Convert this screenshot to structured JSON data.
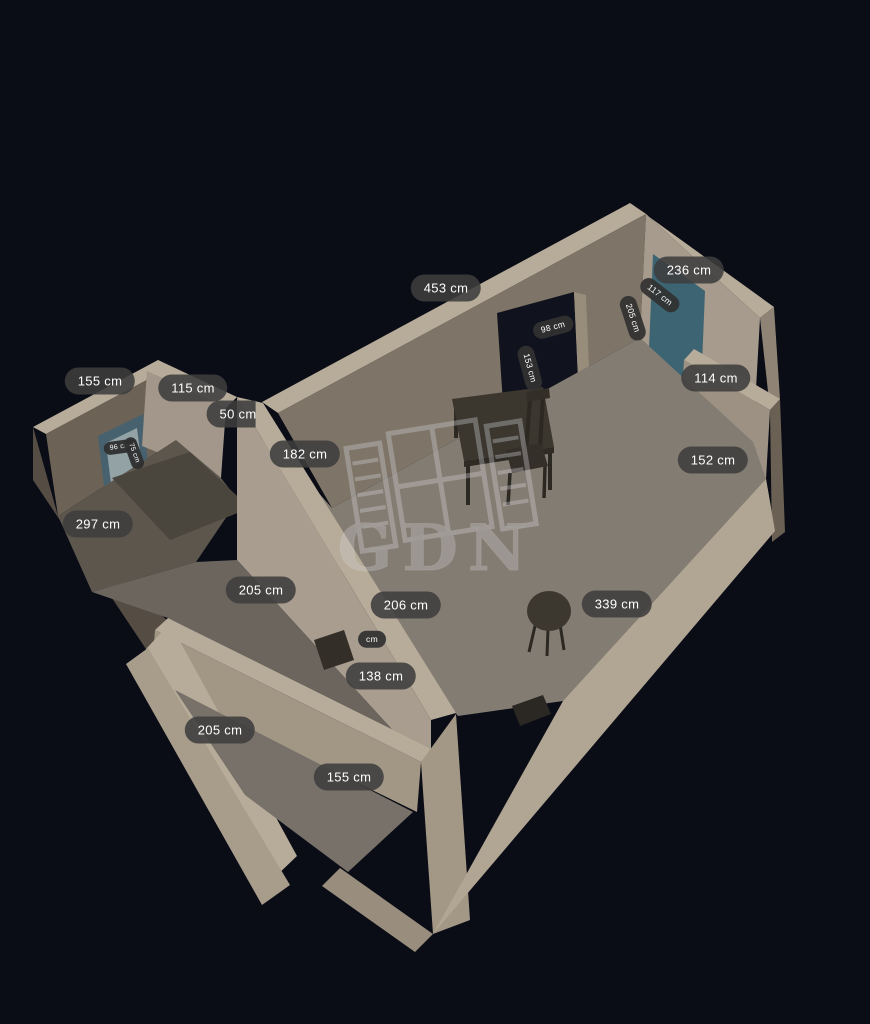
{
  "app": {
    "name": "GDN 3D floorplan viewer",
    "watermark": "GDN",
    "unit": "cm",
    "view": "3d-dollhouse"
  },
  "labels": [
    {
      "text": "453 cm",
      "kind": "wall-length"
    },
    {
      "text": "98 cm",
      "kind": "door-width"
    },
    {
      "text": "153 cm",
      "kind": "door-height"
    },
    {
      "text": "117 cm",
      "kind": "door-width"
    },
    {
      "text": "205 cm",
      "kind": "door-height"
    },
    {
      "text": "236 cm",
      "kind": "wall-length"
    },
    {
      "text": "114 cm",
      "kind": "wall-length"
    },
    {
      "text": "152 cm",
      "kind": "wall-length"
    },
    {
      "text": "155 cm",
      "kind": "wall-length"
    },
    {
      "text": "115 cm",
      "kind": "wall-length"
    },
    {
      "text": "50 cm",
      "kind": "wall-length"
    },
    {
      "text": "96 cm",
      "kind": "window-size"
    },
    {
      "text": "75 cm",
      "kind": "window-size"
    },
    {
      "text": "182 cm",
      "kind": "wall-length"
    },
    {
      "text": "297 cm",
      "kind": "wall-length"
    },
    {
      "text": "205 cm",
      "kind": "wall-length"
    },
    {
      "text": "206 cm",
      "kind": "wall-length"
    },
    {
      "text": "339 cm",
      "kind": "wall-length"
    },
    {
      "text": "cm",
      "kind": "partially-hidden-label"
    },
    {
      "text": "138 cm",
      "kind": "wall-length"
    },
    {
      "text": "205 cm",
      "kind": "wall-length"
    },
    {
      "text": "155 cm",
      "kind": "wall-length"
    }
  ],
  "colors": {
    "background": "#0a0c16",
    "wall_top": "#b7ab99",
    "wall_lit": "#a69b8c",
    "wall_shadow": "#7e7467",
    "wall_dark": "#6c6356",
    "exterior_bright": "#b1a593",
    "floor_main": "#837c72",
    "floor_dark": "#6b655e",
    "teal_door": "#3c6472",
    "dark_door": "#10121d",
    "label_bg": "#3e3e3e",
    "label_text": "#ffffff",
    "watermark": "#d5d6dc",
    "furniture": "#3b362e"
  },
  "furniture": [
    {
      "name": "dining-table"
    },
    {
      "name": "chair"
    },
    {
      "name": "round-table"
    },
    {
      "name": "window-with-shutters"
    }
  ]
}
